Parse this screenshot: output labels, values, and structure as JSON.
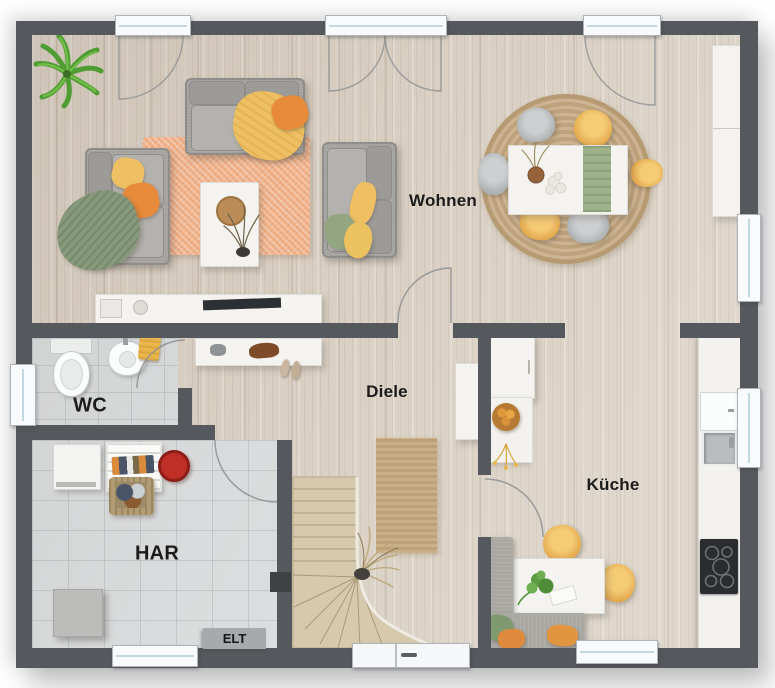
{
  "plan": {
    "kind": "residential-floor-plan",
    "level": "ground-floor"
  },
  "rooms": {
    "wohnen": {
      "label": "Wohnen"
    },
    "diele": {
      "label": "Diele"
    },
    "kueche": {
      "label": "Küche"
    },
    "wc": {
      "label": "WC"
    },
    "har": {
      "label": "HAR"
    },
    "elt": {
      "label": "ELT"
    }
  },
  "palette": {
    "wall": "#55585c",
    "wood_floor": "#d9cfc2",
    "tile_floor": "#d9dbdc",
    "rug_orange": "#f1b28a",
    "rug_jute": "#c9ae8a",
    "sofa_gray": "#a5a39f",
    "furniture_white": "#f4f3f0",
    "accent_yellow": "#eec063",
    "accent_orange": "#e78b3b",
    "accent_green": "#87997b",
    "cooktop_black": "#2a2c2f",
    "label_text": "#1b1b1b"
  }
}
